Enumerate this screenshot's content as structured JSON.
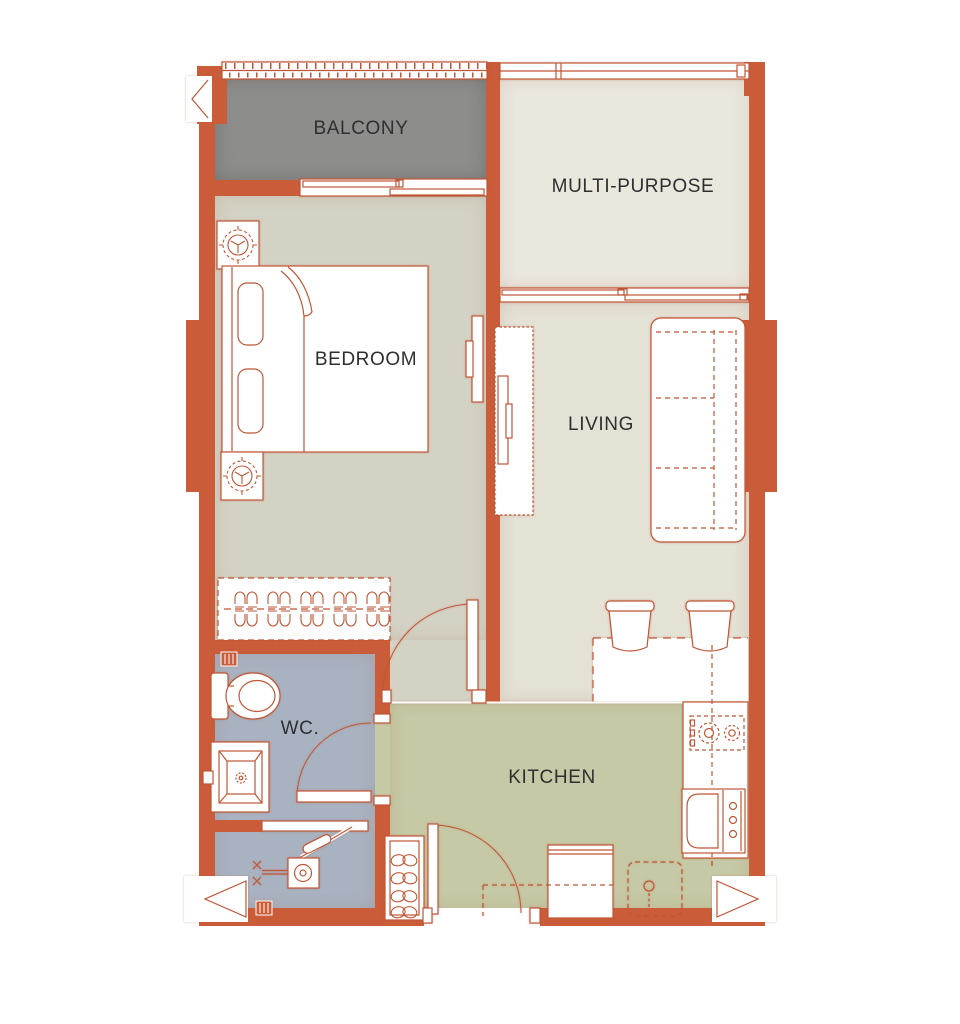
{
  "title": "One-bedroom apartment floor plan",
  "colors": {
    "wall": "#cb5c39",
    "line": "#bf5636",
    "balcony_floor": "#8d8d8b",
    "multipurpose_floor": "#eae7dd",
    "bedroom_floor": "#d4d2c4",
    "hallway_floor": "#d4d2c4",
    "living_floor": "#e4e1d5",
    "wc_floor": "#a9b2c0",
    "kitchen_floor": "#c6c9a5",
    "label_text": "#2f2f31",
    "background": "#ffffff"
  },
  "rooms": {
    "balcony": {
      "label": "BALCONY"
    },
    "multipurpose": {
      "label": "MULTI-PURPOSE"
    },
    "bedroom": {
      "label": "BEDROOM"
    },
    "living": {
      "label": "LIVING"
    },
    "wc": {
      "label": "WC."
    },
    "kitchen": {
      "label": "KITCHEN"
    }
  },
  "furniture_icons": [
    "double-bed-icon",
    "pillow-icon",
    "bedside-lamp-icon",
    "wardrobe-hangers-icon",
    "wall-tv-icon",
    "tv-cabinet-icon",
    "sofa-icon",
    "dining-table-icon",
    "dining-chair-icon",
    "kitchen-counter-icon",
    "cooktop-icon",
    "oven-icon",
    "fridge-icon",
    "washing-machine-icon",
    "shoe-cabinet-icon",
    "toilet-icon",
    "wash-basin-icon",
    "shower-set-icon",
    "door-swing-icon",
    "sliding-window-icon",
    "balcony-railing-icon",
    "direction-arrow-icon",
    "vent-shaft-icon"
  ],
  "markers": [
    "top-left-arrow",
    "bottom-left-arrow",
    "bottom-right-arrow"
  ]
}
